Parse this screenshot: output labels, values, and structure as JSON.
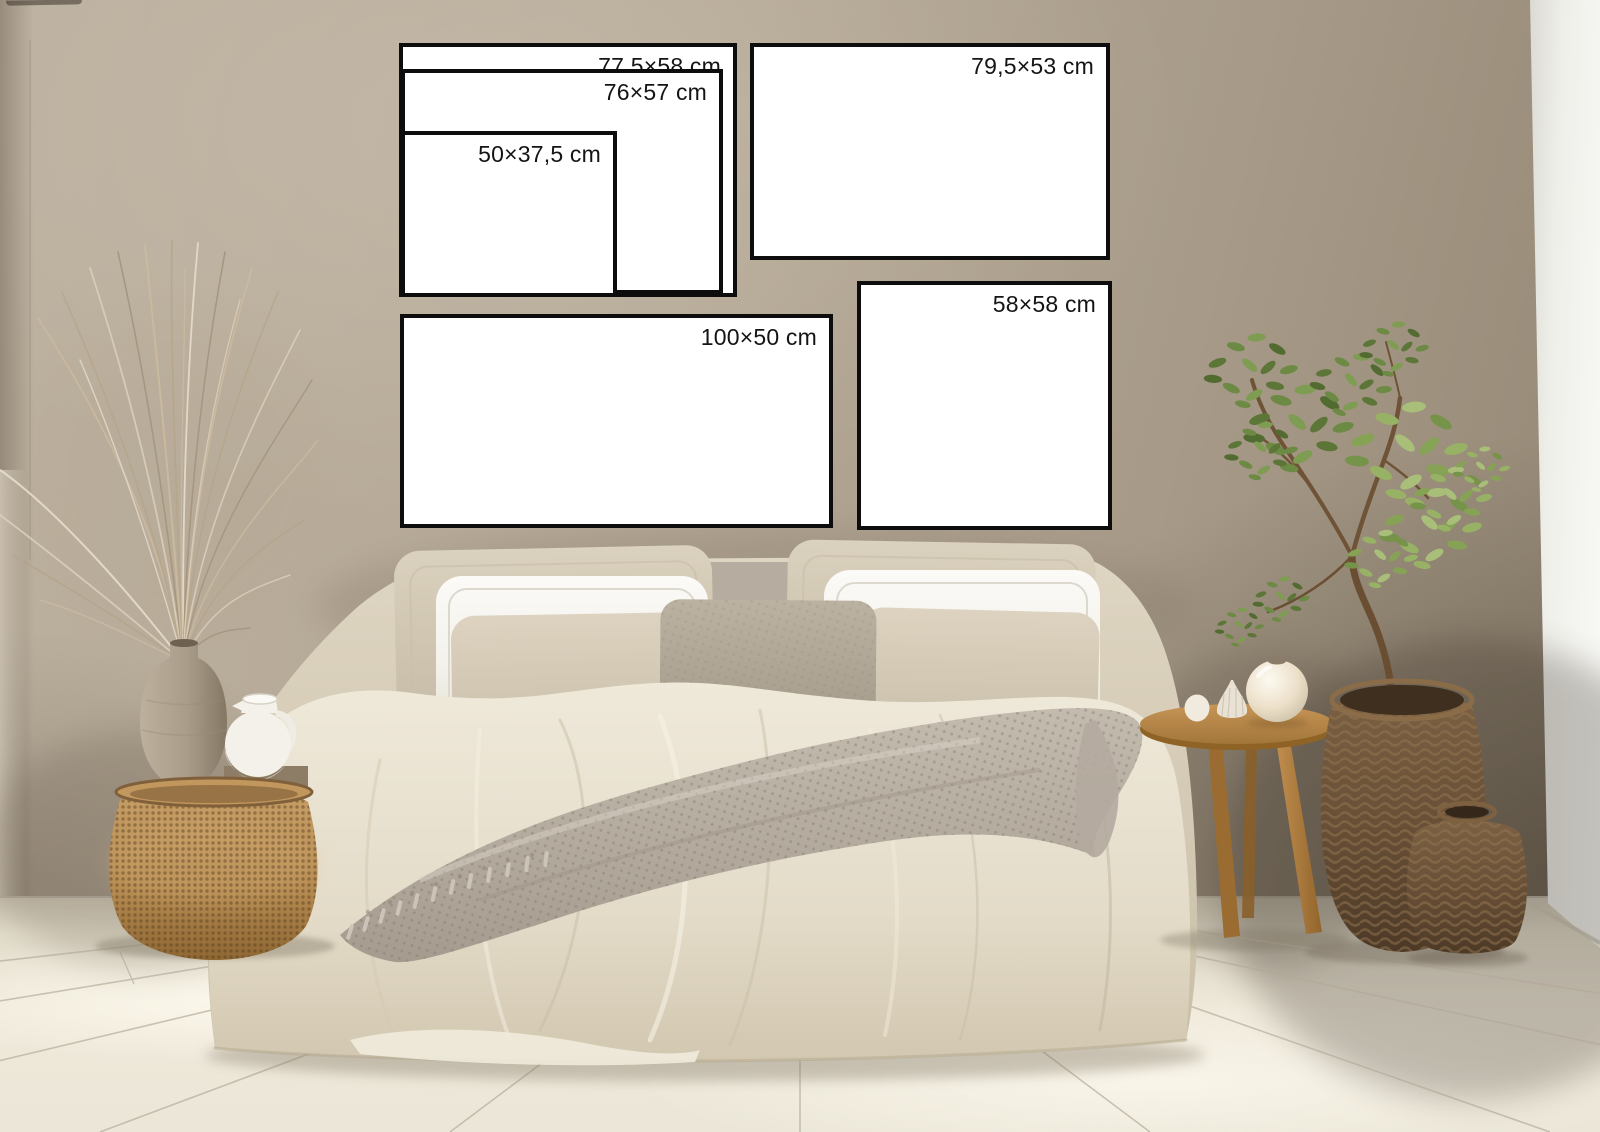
{
  "frames": [
    {
      "name": "nested-outer",
      "label": "77,5×58 cm"
    },
    {
      "name": "nested-middle",
      "label": "76×57 cm"
    },
    {
      "name": "nested-inner",
      "label": "50×37,5 cm"
    },
    {
      "name": "top-right",
      "label": "79,5×53 cm"
    },
    {
      "name": "bottom-left-wide",
      "label": "100×50 cm"
    },
    {
      "name": "bottom-right-square",
      "label": "58×58 cm"
    }
  ],
  "palette": {
    "wall": "#b4a795",
    "wall_dark_corner": "#847868",
    "white_wall": "#f7f7f4",
    "floor": "#ece6d7",
    "floor_seam": "#b2a897",
    "frame_border": "#0d0d0d",
    "frame_background": "#ffffff",
    "label_text": "#141414",
    "bedding_linen": "#e3dccb",
    "pillow_white": "#f7f5f0",
    "throw_gray": "#b6aca0",
    "wicker_tan": "#c0985f",
    "basket_brown": "#5f4a33",
    "wood": "#b08043",
    "plant_green": "#6d8a45"
  }
}
